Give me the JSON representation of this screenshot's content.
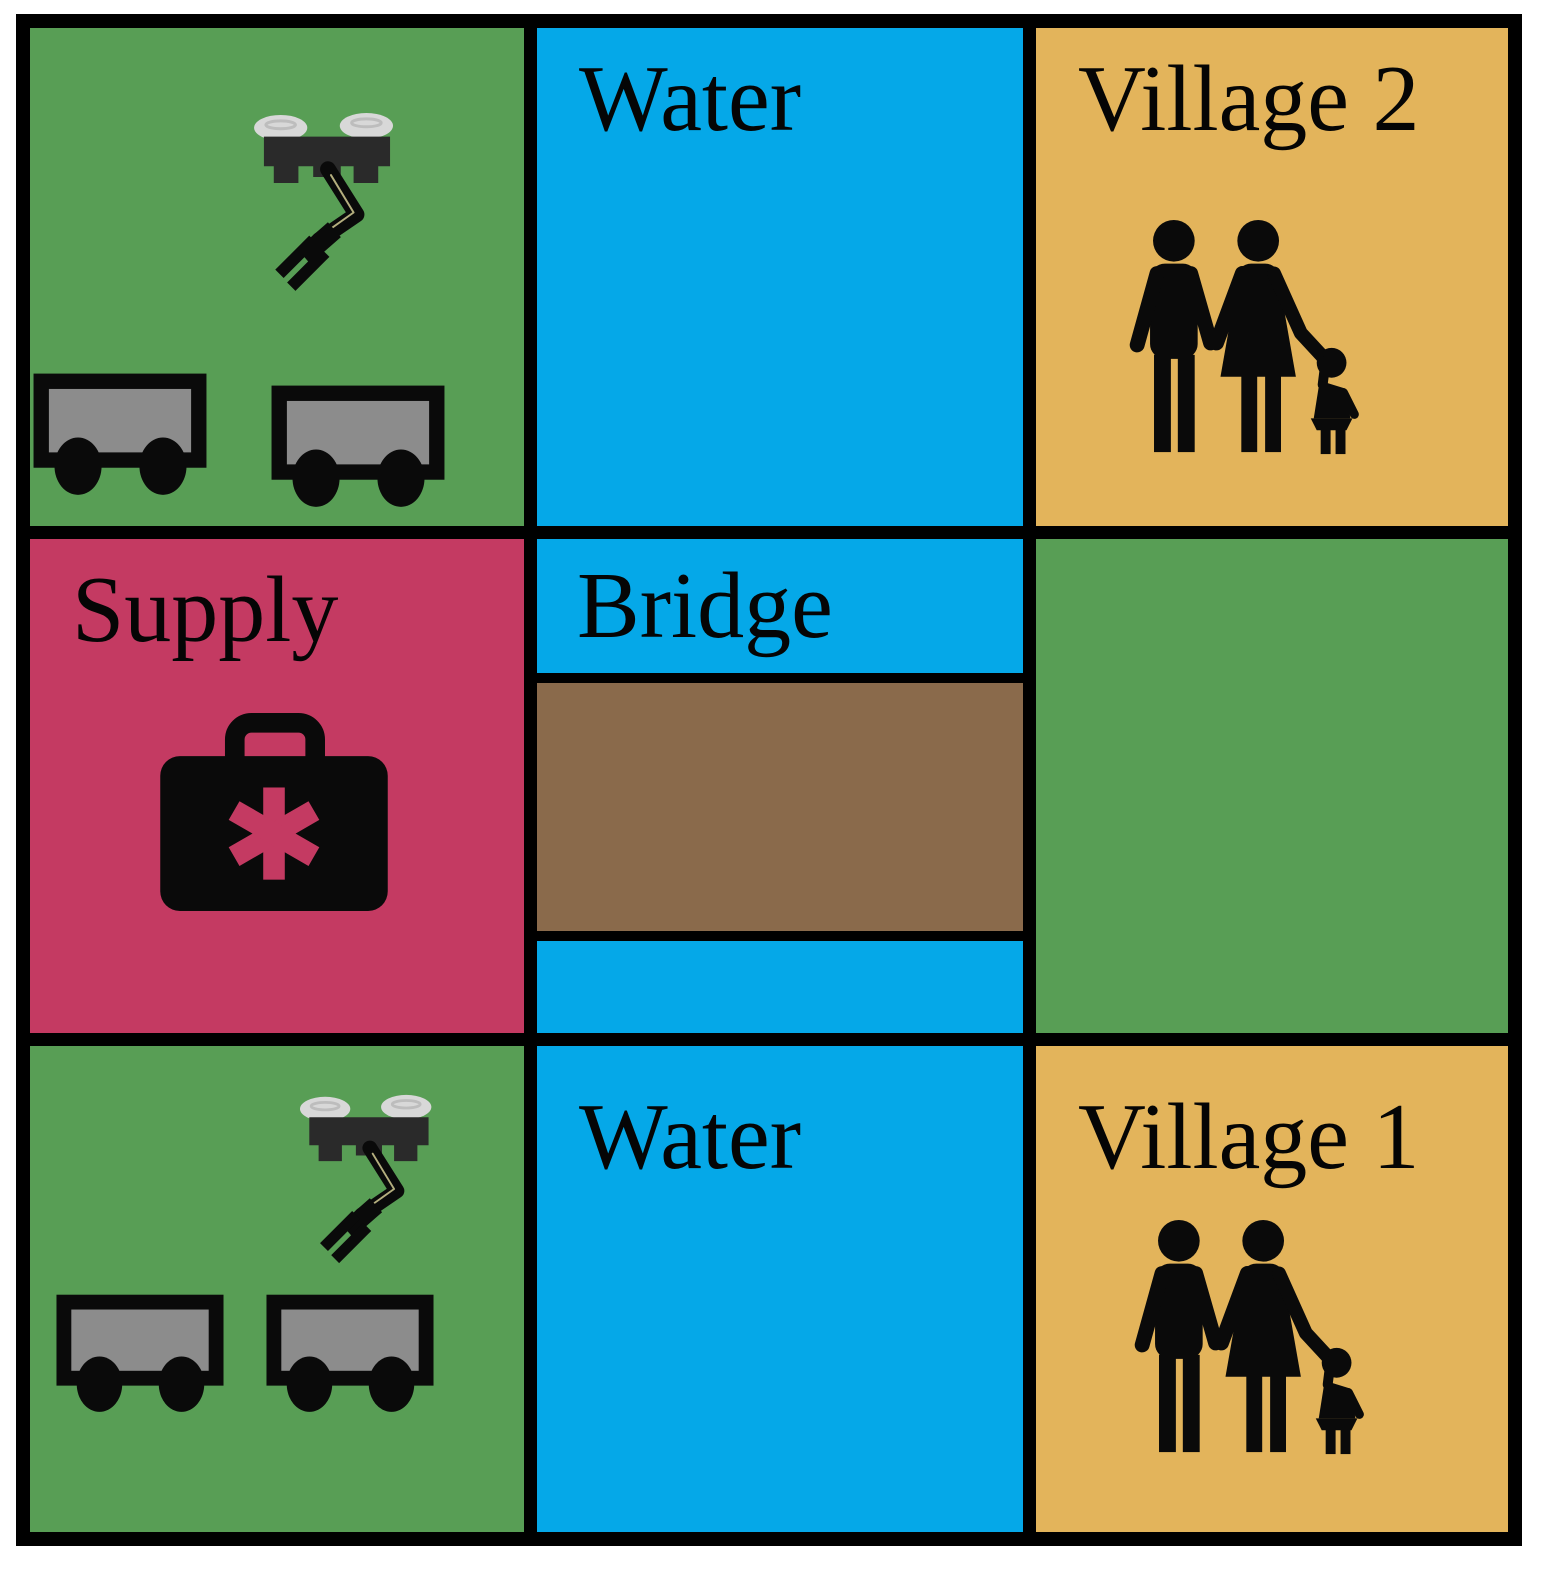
{
  "diagram": {
    "type": "grid-scenario-map",
    "rows": 3,
    "cols": 3,
    "colors": {
      "grass": "#589E55",
      "water": "#05A8E8",
      "village": "#E3B45B",
      "supply": "#C43A62",
      "bridge_deck": "#8A6A4B",
      "grid_line": "#000000",
      "label_ink": "#050505",
      "icon_ink": "#0A0A0A",
      "cart_gray": "#8C8C8C",
      "rotor_gray": "#D8D8D8",
      "rotor_edge": "#BDBDBD",
      "drone_dark": "#2A2A2A",
      "arm_seam": "#B4AE7E"
    },
    "cells": [
      {
        "id": "base-north",
        "row": 1,
        "col": 1,
        "terrain": "grass",
        "label": "",
        "icons": [
          "drone-manipulator",
          "cart",
          "cart"
        ]
      },
      {
        "id": "water-north",
        "row": 1,
        "col": 2,
        "terrain": "water",
        "label": "Water",
        "icons": []
      },
      {
        "id": "village-2",
        "row": 1,
        "col": 3,
        "terrain": "village",
        "label": "Village 2",
        "icons": [
          "family"
        ]
      },
      {
        "id": "supply",
        "row": 2,
        "col": 1,
        "terrain": "supply",
        "label": "Supply",
        "icons": [
          "medical-kit"
        ]
      },
      {
        "id": "bridge",
        "row": 2,
        "col": 2,
        "terrain": "bridge",
        "label": "Bridge",
        "icons": [
          "bridge-deck"
        ]
      },
      {
        "id": "grass-east",
        "row": 2,
        "col": 3,
        "terrain": "grass",
        "label": "",
        "icons": []
      },
      {
        "id": "base-south",
        "row": 3,
        "col": 1,
        "terrain": "grass",
        "label": "",
        "icons": [
          "drone-manipulator",
          "cart",
          "cart"
        ]
      },
      {
        "id": "water-south",
        "row": 3,
        "col": 2,
        "terrain": "water",
        "label": "Water",
        "icons": []
      },
      {
        "id": "village-1",
        "row": 3,
        "col": 3,
        "terrain": "village",
        "label": "Village 1",
        "icons": [
          "family"
        ]
      }
    ]
  }
}
